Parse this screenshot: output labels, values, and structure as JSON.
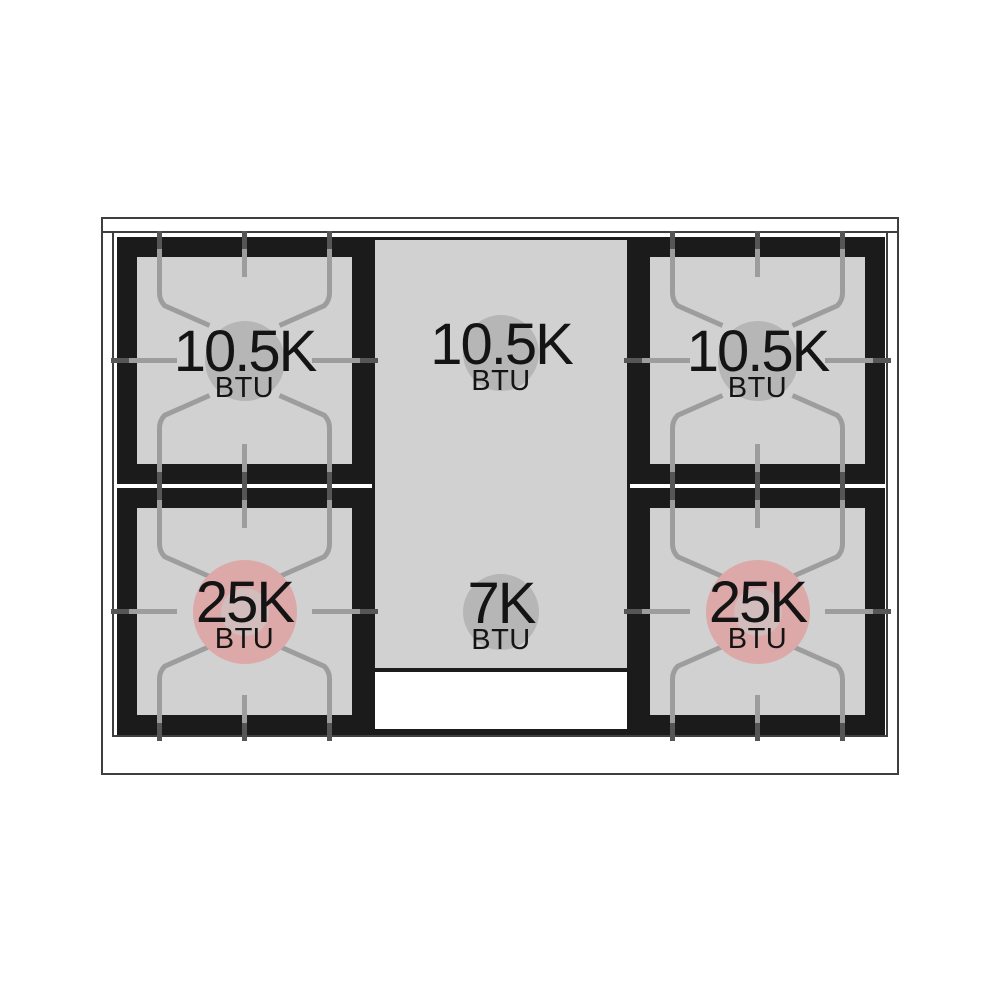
{
  "burners": {
    "top_left": {
      "power": "10.5K",
      "unit": "BTU",
      "style": "grate-standard"
    },
    "center_top": {
      "power": "10.5K",
      "unit": "BTU",
      "style": "griddle"
    },
    "top_right": {
      "power": "10.5K",
      "unit": "BTU",
      "style": "grate-standard"
    },
    "bottom_left": {
      "power": "25K",
      "unit": "BTU",
      "style": "grate-power"
    },
    "center_bottom": {
      "power": "7K",
      "unit": "BTU",
      "style": "griddle"
    },
    "bottom_right": {
      "power": "25K",
      "unit": "BTU",
      "style": "grate-power"
    }
  },
  "colors": {
    "surface_gray": "#d1d1d1",
    "grate_black": "#1b1b1b",
    "grate_line_gray": "#9d9d9d",
    "tick_dark": "#565656",
    "burner_circle_gray": "#b6b6b6",
    "power_burner_pink": "#dca8a8",
    "power_burner_pink_inner": "#d2bcbc",
    "outline": "#3f3f3f",
    "label_text": "#141414",
    "background": "#ffffff"
  }
}
